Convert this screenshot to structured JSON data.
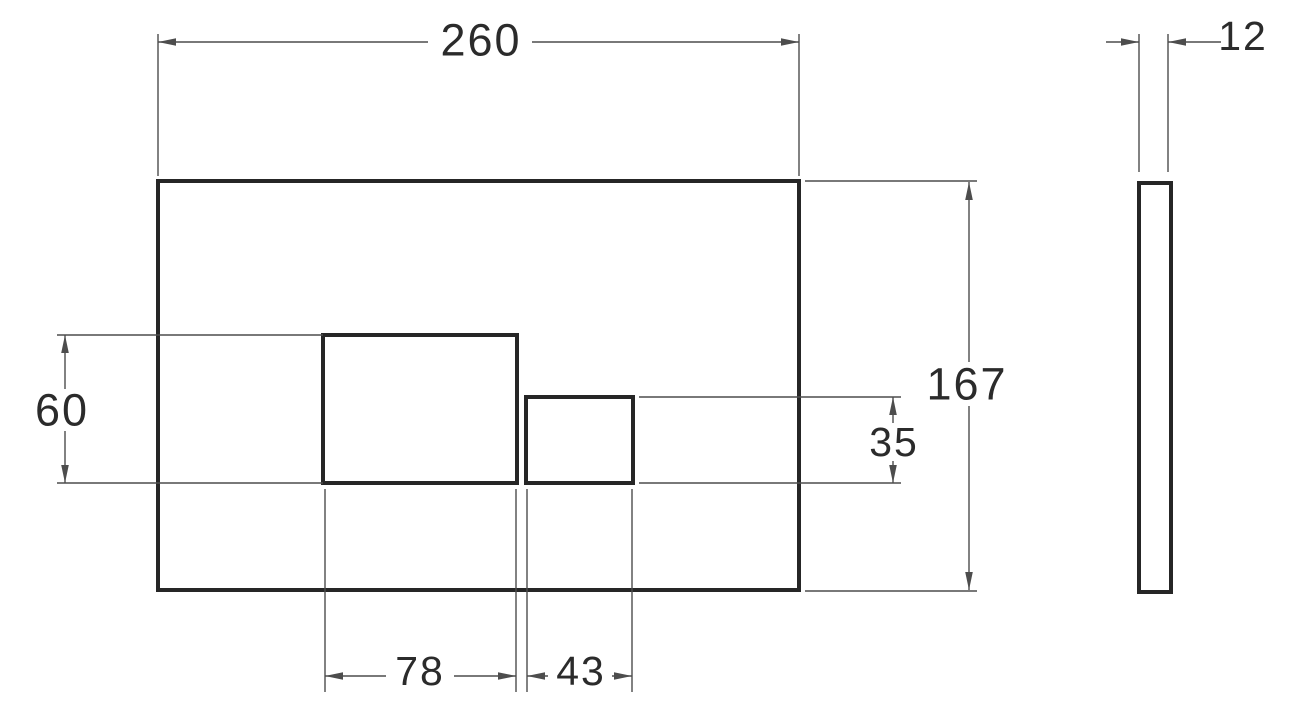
{
  "colors": {
    "background": "#ffffff",
    "outline": "#262626",
    "dimension": "#4d4d4d",
    "label": "#2b2b2b"
  },
  "drawing": {
    "front_view": {
      "overall_width": "260",
      "overall_height": "167",
      "large_button_width": "78",
      "large_button_height": "60",
      "small_button_width": "43",
      "small_button_height": "35"
    },
    "side_view": {
      "thickness": "12"
    }
  }
}
